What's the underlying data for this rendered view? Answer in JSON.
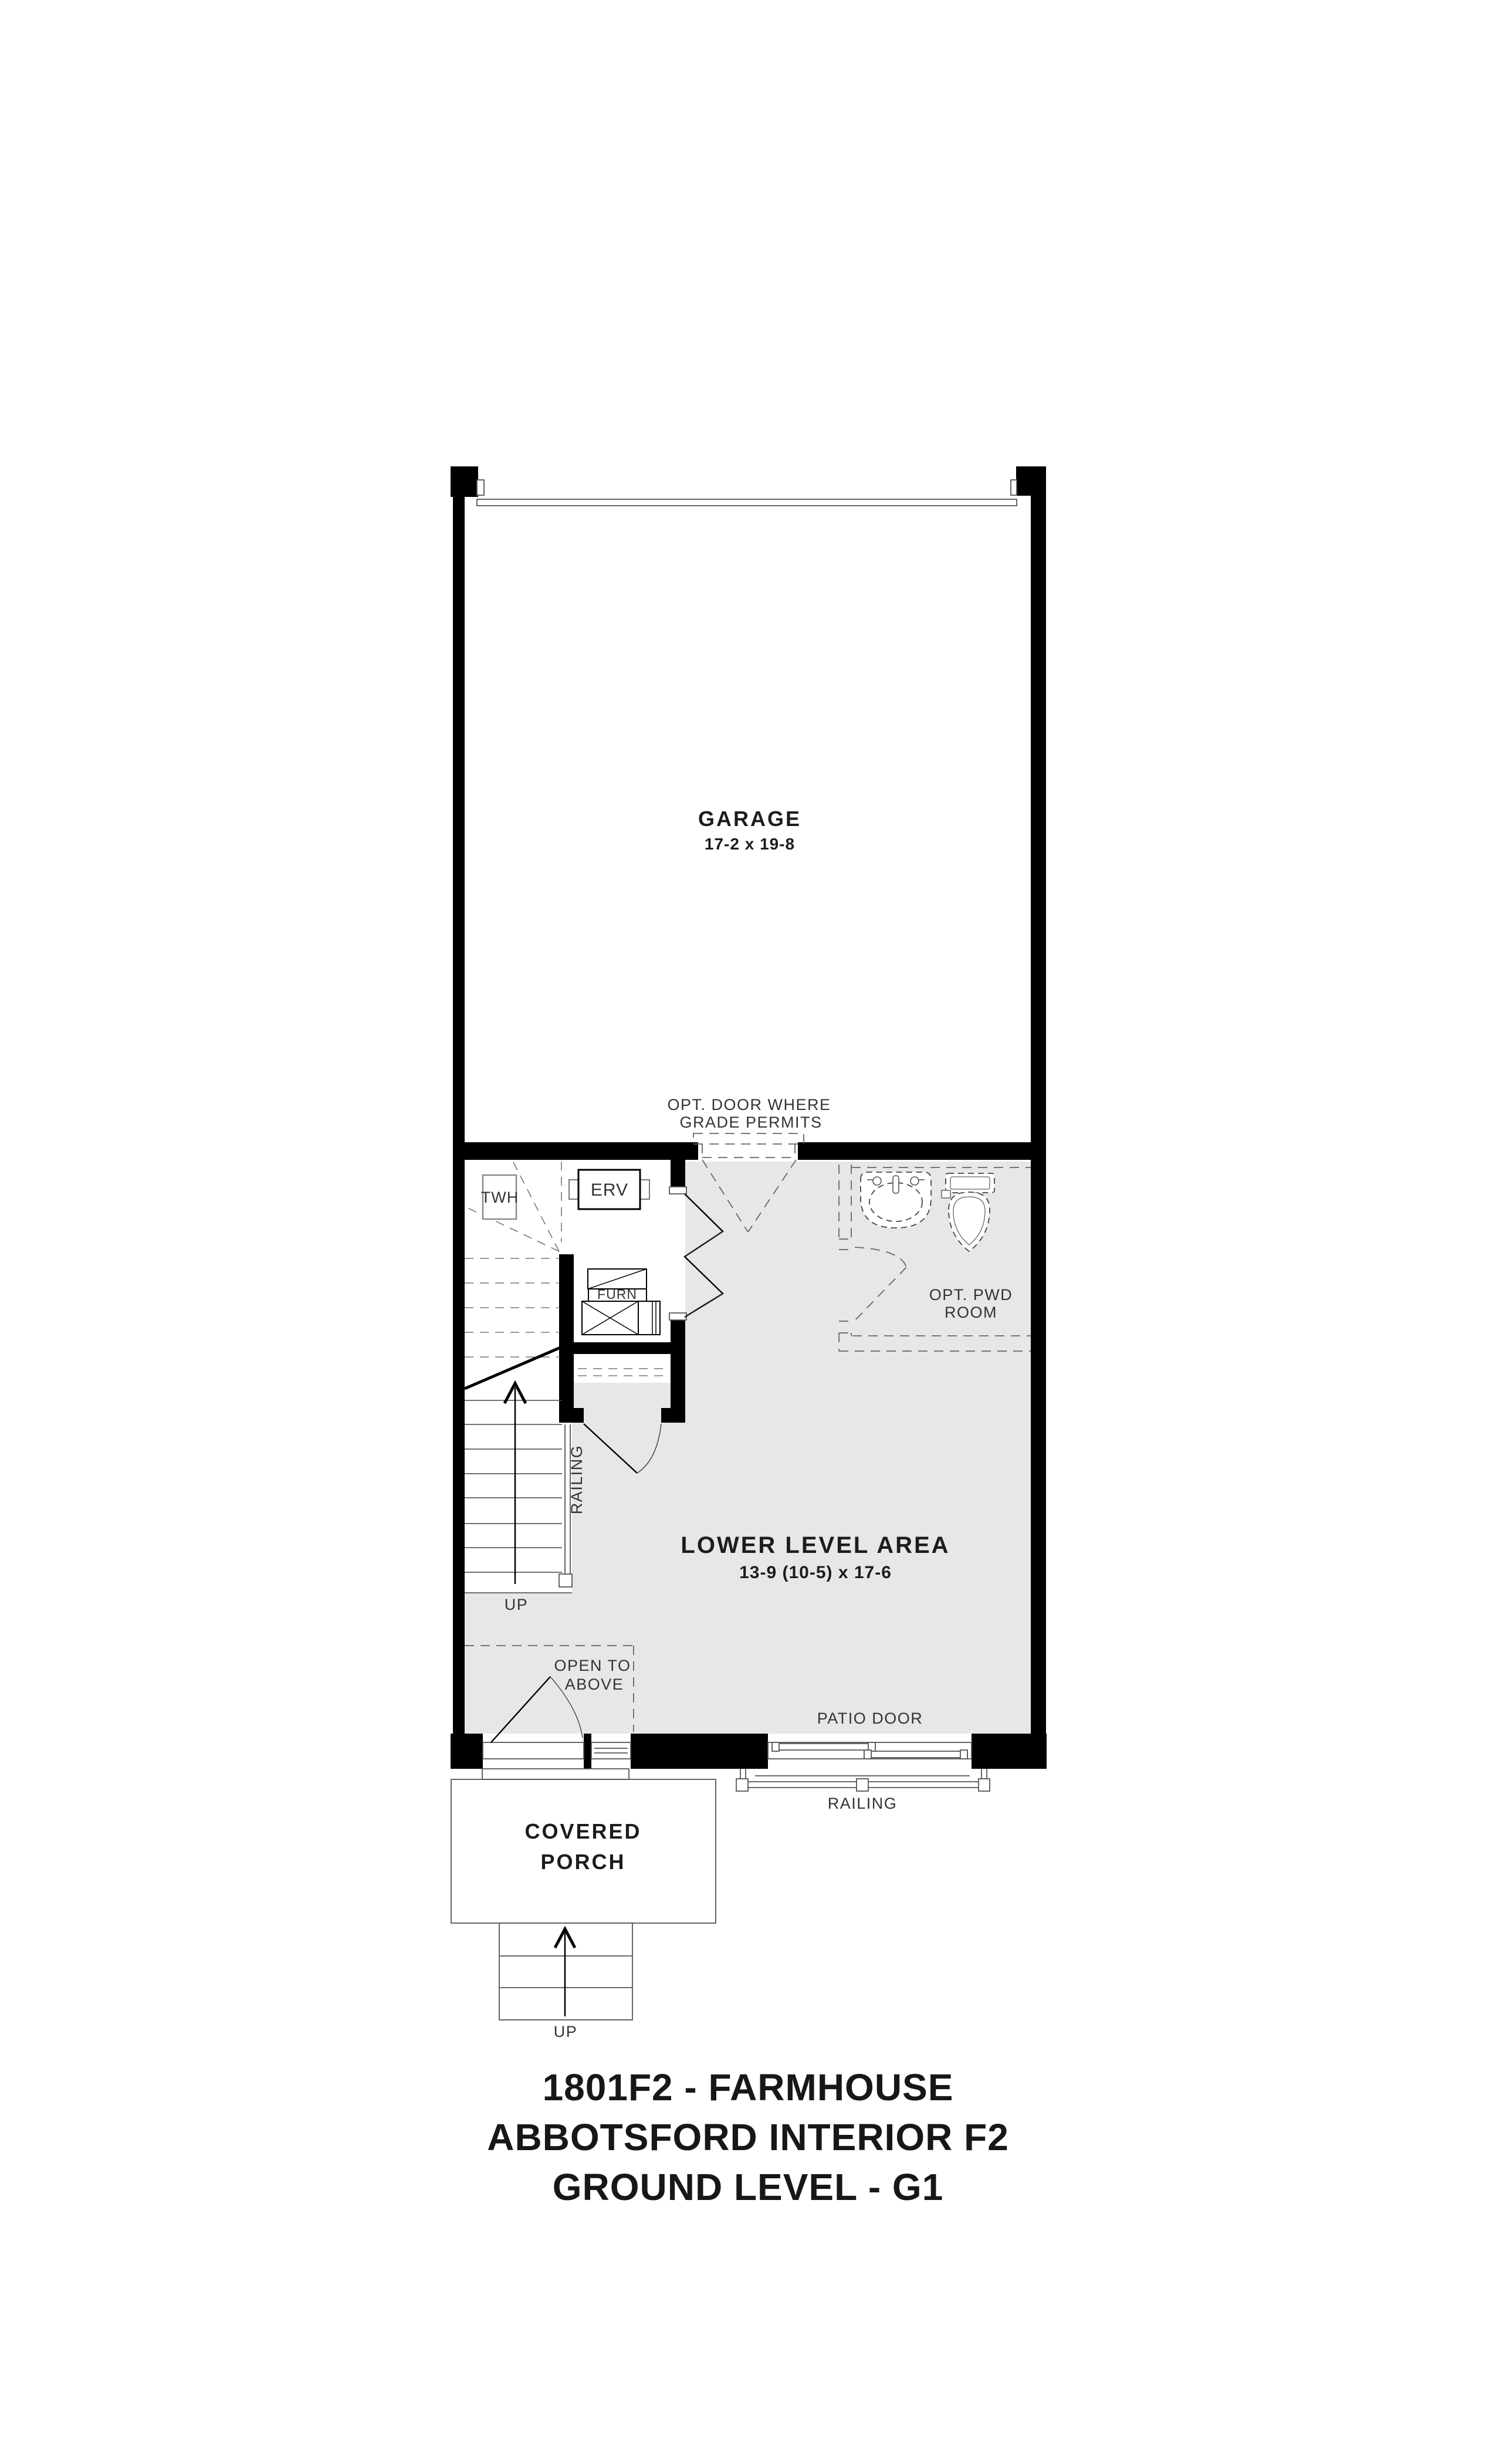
{
  "title_block": {
    "line1": "1801F2 - FARMHOUSE",
    "line2": "ABBOTSFORD INTERIOR F2",
    "line3": "GROUND LEVEL - G1"
  },
  "plan": {
    "rooms": {
      "garage": {
        "name": "GARAGE",
        "dims": "17-2 x 19-8"
      },
      "lower_level": {
        "name": "LOWER LEVEL AREA",
        "dims": "13-9 (10-5) x 17-6"
      },
      "covered_porch": {
        "line1": "COVERED",
        "line2": "PORCH"
      },
      "opt_pwd_room": {
        "line1": "OPT. PWD",
        "line2": "ROOM"
      }
    },
    "labels": {
      "opt_door_line1": "OPT. DOOR WHERE",
      "opt_door_line2": "GRADE PERMITS",
      "open_to_above_line1": "OPEN TO",
      "open_to_above_line2": "ABOVE",
      "patio_door": "PATIO DOOR",
      "railing_patio": "RAILING",
      "railing_stair": "RAILING",
      "up_stair": "UP",
      "up_porch": "UP"
    },
    "equipment": {
      "twh": "TWH",
      "erv": "ERV",
      "furn": "FURN"
    },
    "colors": {
      "wall": "#000000",
      "floor_shade": "#e7e7e7",
      "line": "#555555",
      "text": "#2b2b2b"
    }
  }
}
